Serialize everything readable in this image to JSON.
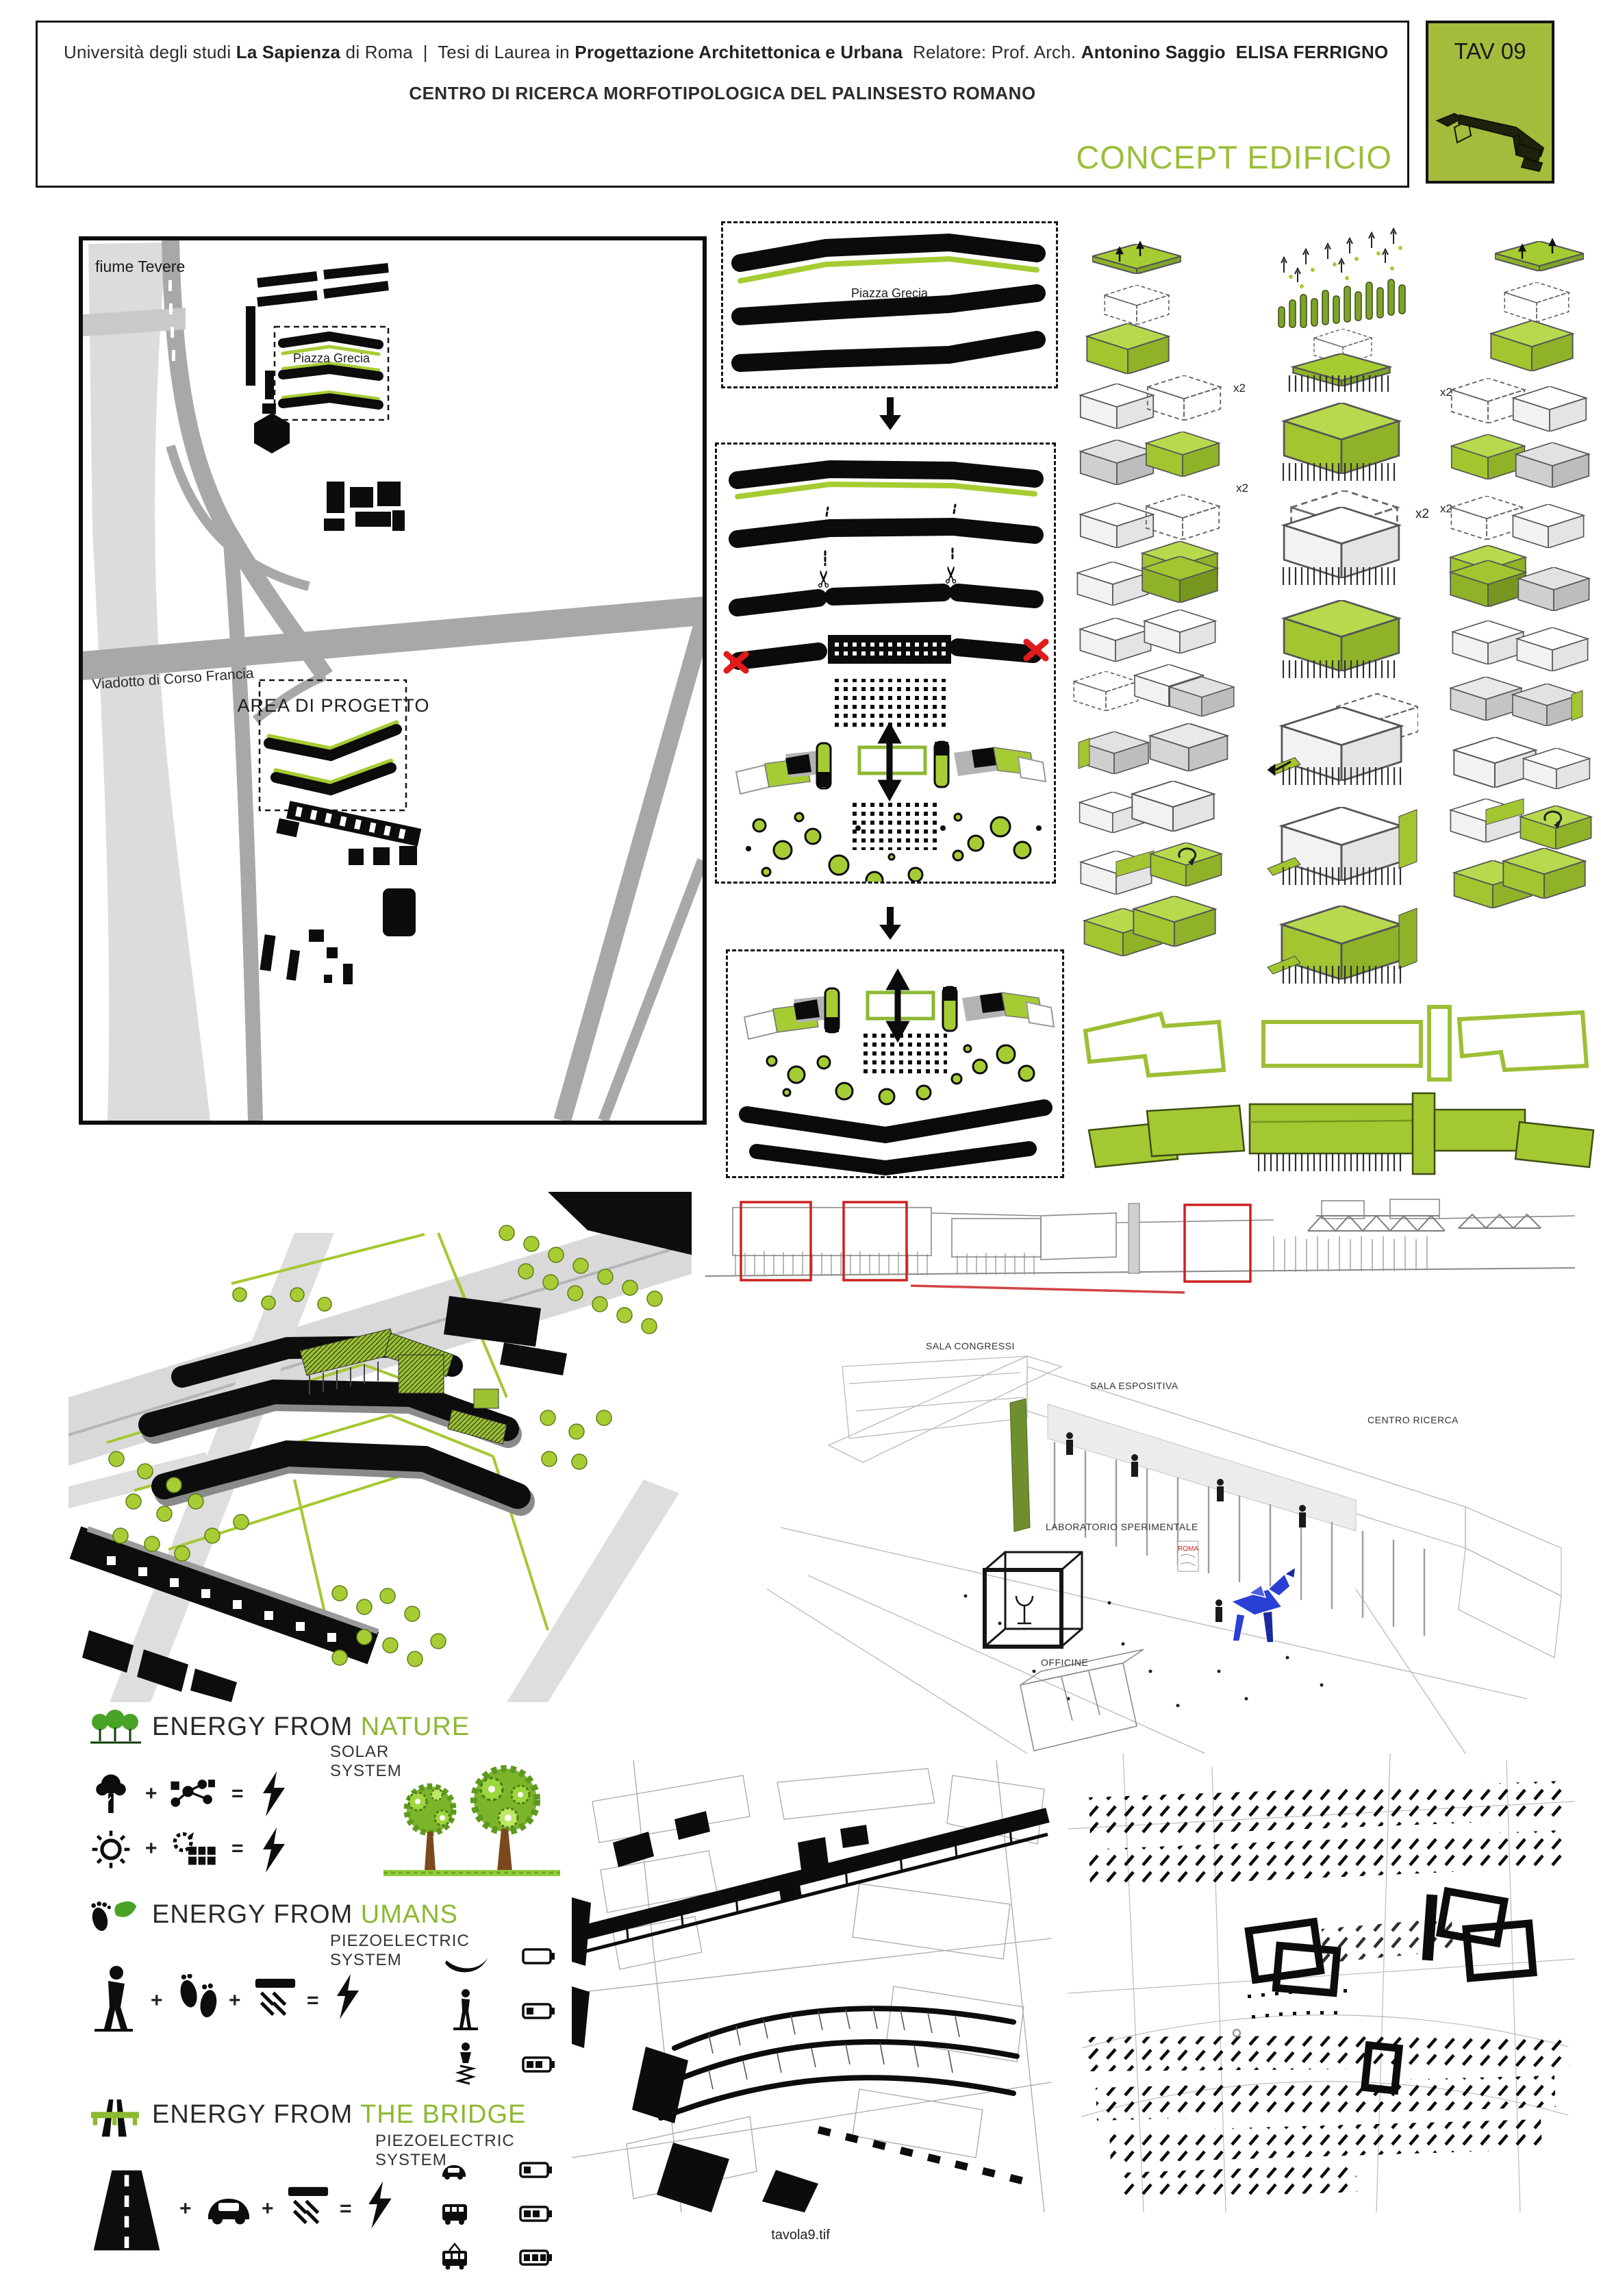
{
  "header": {
    "line1": {
      "t1": "Università degli studi",
      "b1": "La Sapienza",
      "t2": "di Roma",
      "sep": "|",
      "t3": "Tesi di Laurea in",
      "b2": "Progettazione Architettonica e Urbana",
      "t4": "Relatore:",
      "t5": "Prof. Arch.",
      "b3": "Antonino Saggio",
      "b4": "ELISA FERRIGNO"
    },
    "subtitle": "CENTRO DI RICERCA MORFOTIPOLOGICA DEL PALINSESTO ROMANO",
    "board_title": "CONCEPT EDIFICIO",
    "tav": "TAV 09"
  },
  "map": {
    "river": "fiume Tevere",
    "piazza": "Piazza Grecia",
    "viaduct": "Viadotto di Corso Francia",
    "project_area": "AREA DI PROGETTO"
  },
  "concept": {
    "step1_label": "Piazza Grecia",
    "x2": "x2",
    "scissors_glyph": "✂"
  },
  "perspective": {
    "sala_congressi": "SALA CONGRESSI",
    "sala_espositiva": "SALA ESPOSITIVA",
    "centro_ricerca": "CENTRO RICERCA",
    "laboratorio": "LABORATORIO SPERIMENTALE",
    "officine": "OFFICINE",
    "poster_text": "ROMA"
  },
  "energy": {
    "plus": "+",
    "equals": "=",
    "blocks": [
      {
        "prefix": "ENERGY FROM",
        "accent": "NATURE",
        "subtitle": "SOLAR SYSTEM"
      },
      {
        "prefix": "ENERGY FROM",
        "accent": "UMANS",
        "subtitle": "PIEZOELECTRIC SYSTEM"
      },
      {
        "prefix": "ENERGY FROM",
        "accent": "THE BRIDGE",
        "subtitle": "PIEZOELECTRIC SYSTEM"
      }
    ]
  },
  "footer": {
    "filename": "tavola9.tif"
  },
  "colors": {
    "accent_green": "#9bbe3b",
    "diagram_green": "#a6cc33",
    "dark_green": "#7ea32c",
    "red": "#e01b1b",
    "blue": "#2a3fd4",
    "road_gray": "#a8a8a8",
    "river_gray": "#dcdcdc"
  }
}
